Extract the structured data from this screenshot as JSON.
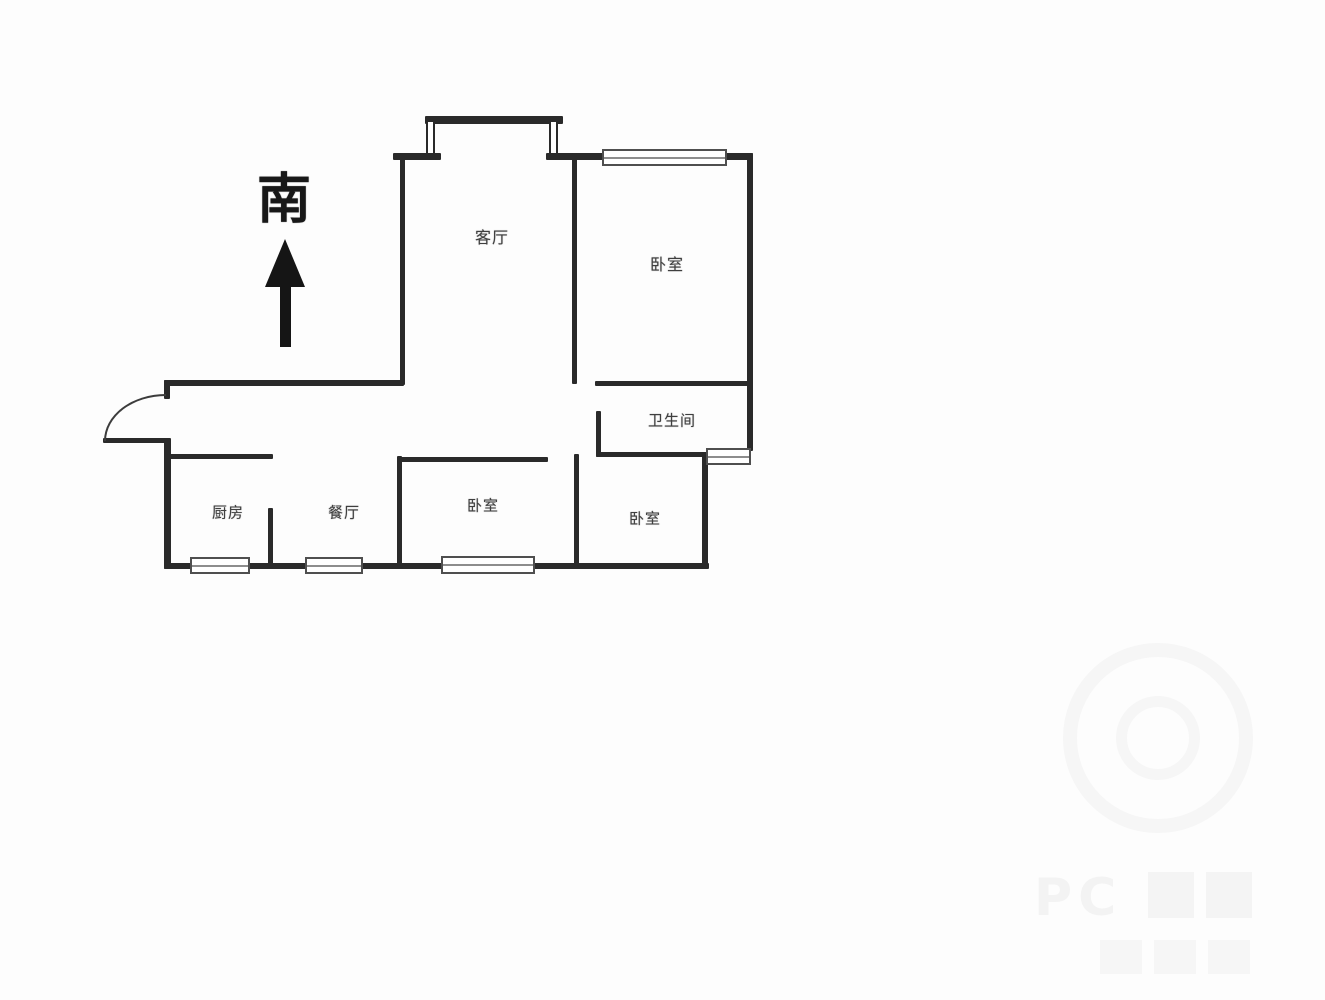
{
  "colors": {
    "background": "#fdfdfd",
    "wall": "#2a2a2a",
    "label_text": "#3f3f3f",
    "window_border": "#4f4f4f",
    "compass": "#151515",
    "watermark": "#505050"
  },
  "floorplan": {
    "compass": {
      "label": "南",
      "direction_note_icon": "up-arrow"
    },
    "rooms": [
      {
        "name": "living-room",
        "label": "客厅",
        "x": 492,
        "y": 236,
        "font_size": 16
      },
      {
        "name": "bedroom-north",
        "label": "卧室",
        "x": 667,
        "y": 263,
        "font_size": 16
      },
      {
        "name": "bathroom",
        "label": "卫生间",
        "x": 672,
        "y": 420,
        "font_size": 15
      },
      {
        "name": "kitchen",
        "label": "厨房",
        "x": 228,
        "y": 512,
        "font_size": 15
      },
      {
        "name": "dining-room",
        "label": "餐厅",
        "x": 344,
        "y": 512,
        "font_size": 15
      },
      {
        "name": "bedroom-south-middle",
        "label": "卧室",
        "x": 483,
        "y": 505,
        "font_size": 15
      },
      {
        "name": "bedroom-south-right",
        "label": "卧室",
        "x": 645,
        "y": 518,
        "font_size": 15
      }
    ],
    "walls": [
      {
        "name": "balcony-top-wall",
        "x": 425,
        "y": 116,
        "w": 138,
        "h": 8,
        "style": "solid"
      },
      {
        "name": "balcony-left-wall",
        "x": 426,
        "y": 122,
        "w": 9,
        "h": 36,
        "style": "double"
      },
      {
        "name": "balcony-right-wall",
        "x": 549,
        "y": 122,
        "w": 9,
        "h": 36,
        "style": "double"
      },
      {
        "name": "top-wall-left-stub",
        "x": 393,
        "y": 153,
        "w": 48,
        "h": 7,
        "style": "solid"
      },
      {
        "name": "top-wall-middle",
        "x": 546,
        "y": 153,
        "w": 58,
        "h": 7,
        "style": "solid"
      },
      {
        "name": "top-wall-right",
        "x": 725,
        "y": 153,
        "w": 28,
        "h": 7,
        "style": "solid"
      },
      {
        "name": "livingroom-left-wall",
        "x": 400,
        "y": 153,
        "w": 5,
        "h": 232,
        "style": "solid"
      },
      {
        "name": "livingroom-bedroom-divider",
        "x": 572,
        "y": 153,
        "w": 5,
        "h": 231,
        "style": "solid"
      },
      {
        "name": "right-exterior-wall",
        "x": 747,
        "y": 153,
        "w": 6,
        "h": 298,
        "style": "solid"
      },
      {
        "name": "bedroom-north-bottom-wall",
        "x": 595,
        "y": 381,
        "w": 153,
        "h": 5,
        "style": "solid"
      },
      {
        "name": "hall-top-wall",
        "x": 164,
        "y": 380,
        "w": 240,
        "h": 6,
        "style": "solid"
      },
      {
        "name": "entry-door-jamb-stub",
        "x": 164,
        "y": 380,
        "w": 6,
        "h": 19,
        "style": "solid"
      },
      {
        "name": "entry-door-leaf",
        "x": 103,
        "y": 438,
        "w": 64,
        "h": 5,
        "style": "solid"
      },
      {
        "name": "left-exterior-wall",
        "x": 164,
        "y": 438,
        "w": 7,
        "h": 131,
        "style": "solid"
      },
      {
        "name": "kitchen-top-wall",
        "x": 167,
        "y": 454,
        "w": 106,
        "h": 5,
        "style": "solid"
      },
      {
        "name": "kitchen-dining-divider",
        "x": 268,
        "y": 508,
        "w": 5,
        "h": 60,
        "style": "solid"
      },
      {
        "name": "bottom-exterior-wall",
        "x": 164,
        "y": 563,
        "w": 545,
        "h": 6,
        "style": "solid"
      },
      {
        "name": "bedroom-middle-left-wall",
        "x": 397,
        "y": 456,
        "w": 5,
        "h": 112,
        "style": "solid"
      },
      {
        "name": "bedroom-middle-top-wall",
        "x": 397,
        "y": 457,
        "w": 151,
        "h": 5,
        "style": "solid"
      },
      {
        "name": "bedroom-right-left-wall",
        "x": 574,
        "y": 454,
        "w": 5,
        "h": 113,
        "style": "solid"
      },
      {
        "name": "bathroom-left-wall",
        "x": 596,
        "y": 411,
        "w": 5,
        "h": 46,
        "style": "solid"
      },
      {
        "name": "bathroom-bottom-wall",
        "x": 596,
        "y": 452,
        "w": 114,
        "h": 5,
        "style": "solid"
      },
      {
        "name": "bedroom-right-right-wall",
        "x": 702,
        "y": 452,
        "w": 6,
        "h": 115,
        "style": "solid"
      }
    ],
    "windows": [
      {
        "name": "bedroom-north-window",
        "x": 602,
        "y": 149,
        "w": 125,
        "h": 17
      },
      {
        "name": "bathroom-window",
        "x": 706,
        "y": 448,
        "w": 45,
        "h": 17
      },
      {
        "name": "kitchen-window",
        "x": 190,
        "y": 557,
        "w": 60,
        "h": 17
      },
      {
        "name": "dining-window",
        "x": 305,
        "y": 557,
        "w": 58,
        "h": 17
      },
      {
        "name": "bedroom-middle-window",
        "x": 441,
        "y": 556,
        "w": 94,
        "h": 18
      }
    ]
  },
  "watermark": {
    "text": "PC"
  }
}
